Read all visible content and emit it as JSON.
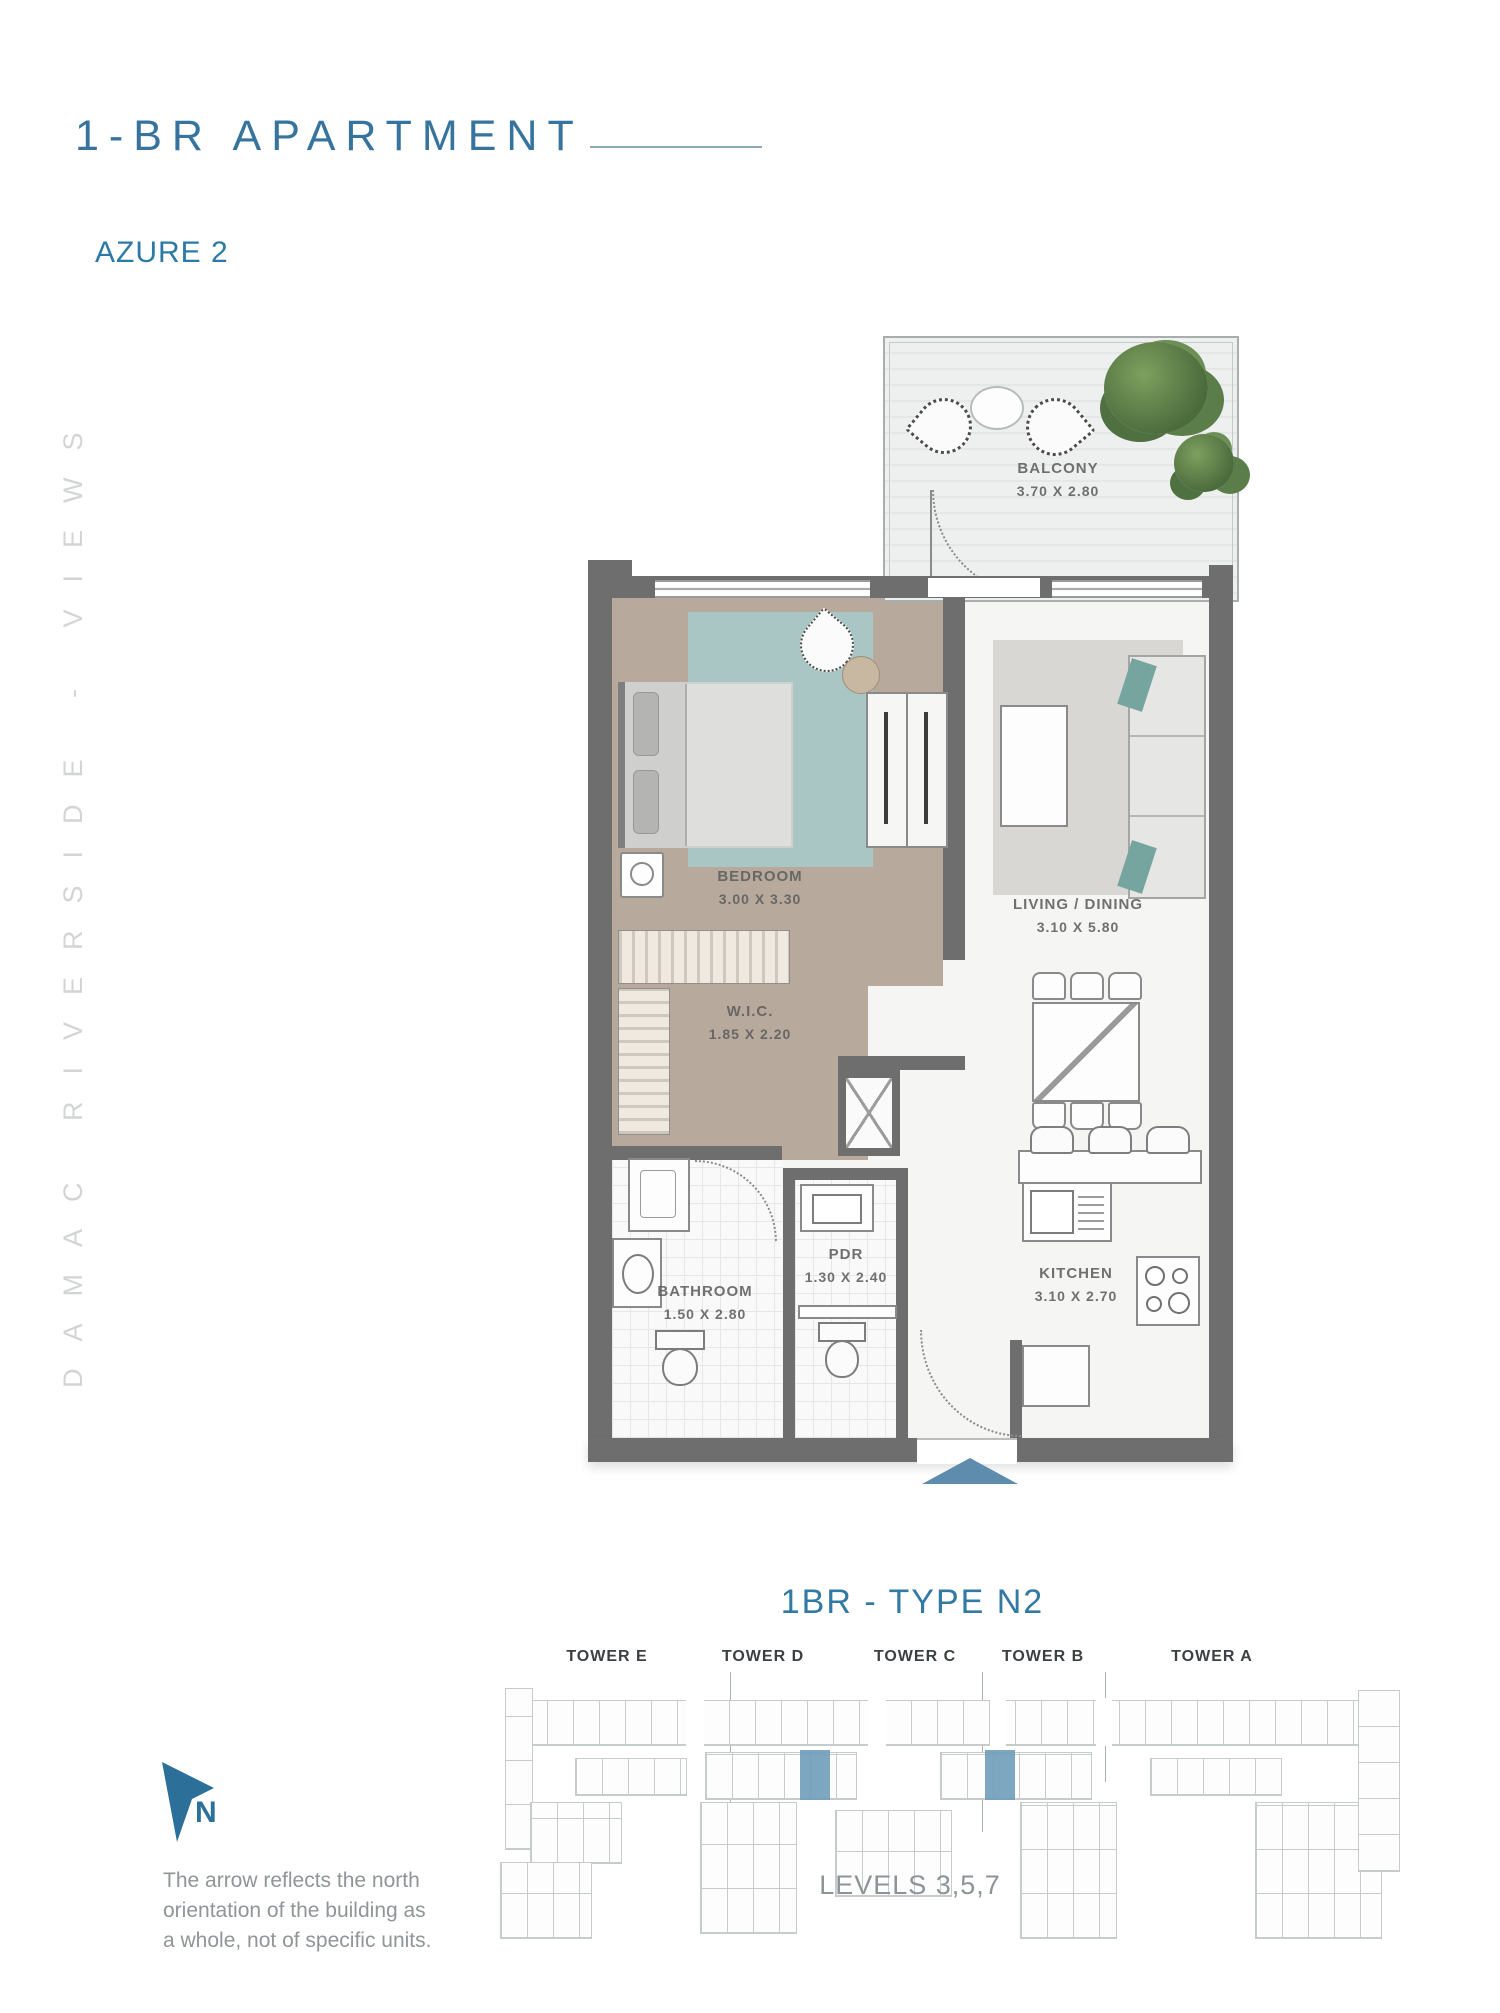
{
  "header": {
    "title": "1-BR APARTMENT",
    "subtitle": "AZURE 2"
  },
  "side_text": "DAMAC RIVERSIDE - VIEWS",
  "floor_plan": {
    "rooms": [
      {
        "name": "BALCONY",
        "dims": "3.70 X 2.80"
      },
      {
        "name": "BEDROOM",
        "dims": "3.00 X 3.30"
      },
      {
        "name": "LIVING / DINING",
        "dims": "3.10 X 5.80"
      },
      {
        "name": "W.I.C.",
        "dims": "1.85 X 2.20"
      },
      {
        "name": "BATHROOM",
        "dims": "1.50 X 2.80"
      },
      {
        "name": "PDR",
        "dims": "1.30 X 2.40"
      },
      {
        "name": "KITCHEN",
        "dims": "3.10 X 2.70"
      }
    ]
  },
  "unit_info": {
    "type_title": "1BR - TYPE N2",
    "levels": "LEVELS 3,5,7"
  },
  "site_plan": {
    "towers": [
      "TOWER E",
      "TOWER D",
      "TOWER C",
      "TOWER B",
      "TOWER A"
    ]
  },
  "compass": {
    "north_label": "N",
    "note_lines": [
      "The arrow reflects the north",
      "orientation of  the building as",
      "a whole, not of specific units."
    ]
  },
  "colors": {
    "accent_blue": "#2f76a0",
    "wall_gray": "#6e6e6e",
    "highlight_blue": "#6f9cba"
  }
}
